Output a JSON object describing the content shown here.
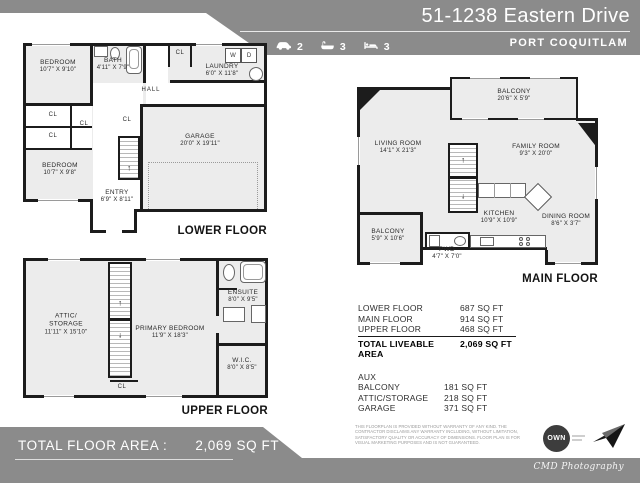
{
  "header": {
    "title": "51-1238 Eastern Drive",
    "city": "PORT COQUITLAM",
    "stats": {
      "cars": "2",
      "baths": "3",
      "beds": "3"
    }
  },
  "plans": {
    "lower": {
      "title": "LOWER FLOOR",
      "bedroom1": {
        "name": "BEDROOM",
        "dims": "10'7\" X 9'10\""
      },
      "bath": {
        "name": "BATH",
        "dims": "4'11\" X 7'9\""
      },
      "laundry": {
        "name": "LAUNDRY",
        "dims": "6'0\" X 11'8\""
      },
      "hall": "HALL",
      "cl": "CL",
      "washer": "W",
      "dryer": "D",
      "garage": {
        "name": "GARAGE",
        "dims": "20'0\" X 19'11\""
      },
      "bedroom2": {
        "name": "BEDROOM",
        "dims": "10'7\" X 9'8\""
      },
      "entry": {
        "name": "ENTRY",
        "dims": "6'9\" X 8'11\""
      }
    },
    "main": {
      "title": "MAIN FLOOR",
      "balcony_top": {
        "name": "BALCONY",
        "dims": "20'6\" X 5'9\""
      },
      "living": {
        "name": "LIVING ROOM",
        "dims": "14'1\" X 21'3\""
      },
      "family": {
        "name": "FAMILY ROOM",
        "dims": "9'3\" X 20'0\""
      },
      "kitchen": {
        "name": "KITCHEN",
        "dims": "10'9\" X 10'9\""
      },
      "dining": {
        "name": "DINING ROOM",
        "dims": "8'6\" X 3'7\""
      },
      "balcony_bottom": {
        "name": "BALCONY",
        "dims": "5'9\" X 10'6\""
      },
      "pwd": {
        "name": "PWD",
        "dims": "4'7\" X 7'0\""
      }
    },
    "upper": {
      "title": "UPPER FLOOR",
      "attic_line1": "ATTIC/",
      "attic_line2": "STORAGE",
      "attic_dims": "11'11\" X 15'10\"",
      "primary": {
        "name": "PRIMARY BEDROOM",
        "dims": "11'9\" X 18'3\""
      },
      "ensuite": {
        "name": "ENSUITE",
        "dims": "8'0\" X 9'5\""
      },
      "wic": {
        "name": "W.I.C.",
        "dims": "8'0\" X 8'5\""
      },
      "cl": "CL"
    }
  },
  "area_table": {
    "rows": [
      {
        "label": "LOWER FLOOR",
        "value": "687 SQ FT"
      },
      {
        "label": "MAIN FLOOR",
        "value": "914 SQ FT"
      },
      {
        "label": "UPPER FLOOR",
        "value": "468 SQ FT"
      }
    ],
    "total": {
      "label": "TOTAL LIVEABLE AREA",
      "value": "2,069 SQ FT"
    },
    "aux_label": "AUX",
    "aux_rows": [
      {
        "label": "BALCONY",
        "value": "181 SQ FT"
      },
      {
        "label": "ATTIC/STORAGE",
        "value": "218 SQ FT"
      },
      {
        "label": "GARAGE",
        "value": "371 SQ FT"
      }
    ]
  },
  "footer": {
    "total_label": "TOTAL FLOOR AREA :",
    "total_value": "2,069 SQ FT",
    "disclaimer": "THIS FLOORPLAN IS PROVIDED WITHOUT WARRANTY OF ANY KIND. THE CONTRACTOR DISCLAIMS ANY WARRANTY INCLUDING, WITHOUT LIMITATION, SATISFACTORY QUALITY OR ACCURACY OF DIMENSIONS. FLOOR PLAN IS FOR VISUAL MARKETING PURPOSES AND IS NOT GUARANTEED.",
    "own_logo": "OWN",
    "credit": "CMD Photography"
  },
  "colors": {
    "band": "#8b8b8b",
    "room_fill": "#ececec",
    "wall": "#1c1c1c",
    "logo_circle": "#3d3d3d"
  }
}
